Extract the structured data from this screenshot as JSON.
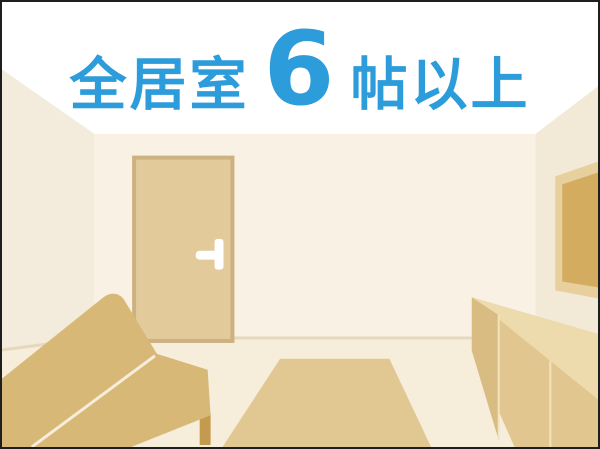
{
  "headline": {
    "prefix": "全居室",
    "number": "6",
    "suffix": "帖以上"
  },
  "colors": {
    "headline_blue": "#2D9CDB",
    "ceiling": "#FFFFFF",
    "back_wall": "#F9F2E4",
    "left_wall": "#F3EBDB",
    "right_wall": "#F2E9D6",
    "floor": "#F6EDDA",
    "baseboard": "#E6D8BD",
    "door": "#E3CA9B",
    "door_frame": "#CDB180",
    "door_handle": "#FFFFFF",
    "sofa": "#D7B877",
    "sofa_leg": "#C49A4F",
    "sofa_seam": "#F6EDDA",
    "rug": "#E1C893",
    "cabinet_front": "#E2C68F",
    "cabinet_end": "#D9BC82",
    "cabinet_top": "#EDDBAE",
    "cabinet_line": "#F2E3BD",
    "art_frame": "#E7CF9E",
    "art_inner": "#D3AC60"
  }
}
